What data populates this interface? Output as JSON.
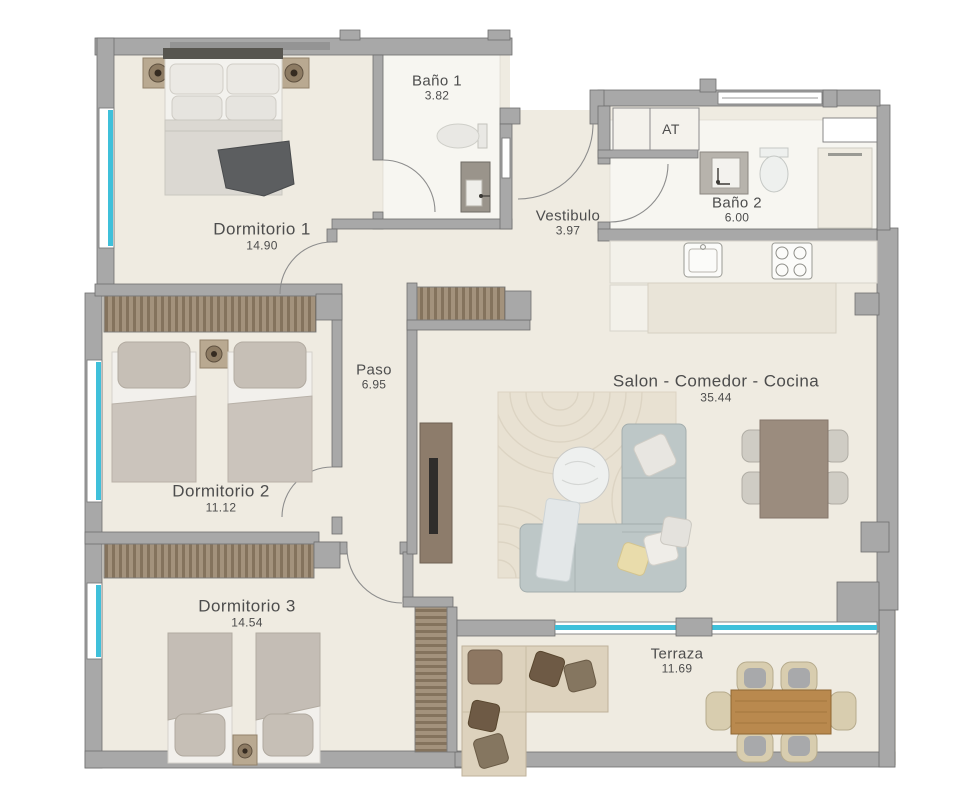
{
  "plan": {
    "rooms": {
      "dormitorio1": {
        "name": "Dormitorio 1",
        "area": "14.90"
      },
      "banyo1": {
        "name": "Baño 1",
        "area": "3.82"
      },
      "vestibulo": {
        "name": "Vestibulo",
        "area": "3.97"
      },
      "banyo2": {
        "name": "Baño 2",
        "area": "6.00"
      },
      "at": {
        "name": "AT"
      },
      "paso": {
        "name": "Paso",
        "area": "6.95"
      },
      "dormitorio2": {
        "name": "Dormitorio 2",
        "area": "11.12"
      },
      "salon": {
        "name": "Salon - Comedor - Cocina",
        "area": "35.44"
      },
      "dormitorio3": {
        "name": "Dormitorio 3",
        "area": "14.54"
      },
      "terraza": {
        "name": "Terraza",
        "area": "11.69"
      }
    },
    "colors": {
      "wall": "#a8a8a8",
      "wall_line": "#6f6f6f",
      "floor": "#efebe1",
      "bath_floor": "#f7f6f1",
      "glass": "#3fc0da",
      "wardrobe": "#a3927c",
      "wardrobe_dark": "#84735d",
      "text": "#4d4d4d",
      "wood": "#b9894e",
      "sofa": "#bdc7c7",
      "outdoor": "#ddd2bd",
      "rug": "#e8e1d2",
      "tan": "#b9a991",
      "dark_accent": "#5c5e60"
    }
  }
}
